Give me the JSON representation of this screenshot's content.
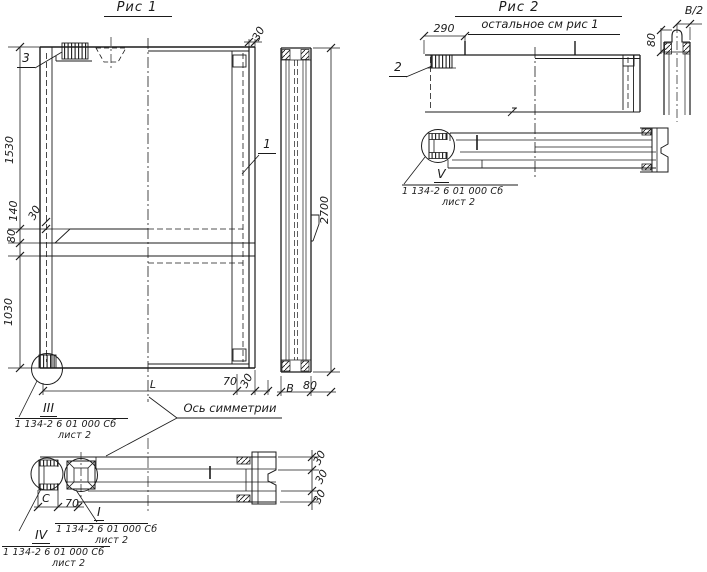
{
  "figure1": {
    "title": "Рис 1",
    "axis_label": "Ось симметрии",
    "callouts": {
      "c1": "1",
      "c3": "3"
    },
    "dims": {
      "h1530": "1530",
      "h140": "140",
      "h30": "30",
      "h80": "80",
      "h1030": "1030",
      "top30": "30",
      "right2700": "2700",
      "bottomL": "L",
      "bottom70": "70",
      "bottom30": "30",
      "sideB": "В",
      "side80": "80"
    },
    "detail_iii": {
      "ref": "III",
      "doc": "1 134-2 6 01 000 Сб",
      "sheet": "лист 2"
    },
    "section": {
      "dimC": "С",
      "dim70": "70",
      "d30": [
        "30",
        "30",
        "30"
      ],
      "detail_i": {
        "ref": "I",
        "doc": "1 134-2 6 01 000 Сб",
        "sheet": "лист 2"
      },
      "detail_iv": {
        "ref": "IV",
        "doc": "1 134-2 6 01 000 Сб",
        "sheet": "лист 2"
      }
    }
  },
  "figure2": {
    "title": "Рис 2",
    "subtitle": "остальное см рис 1",
    "callouts": {
      "c2": "2"
    },
    "dims": {
      "w290": "290",
      "halfB": "В/2",
      "v80": "80"
    },
    "detail_v": {
      "ref": "V",
      "doc": "1 134-2 6 01 000 Сб",
      "sheet": "лист 2"
    }
  }
}
